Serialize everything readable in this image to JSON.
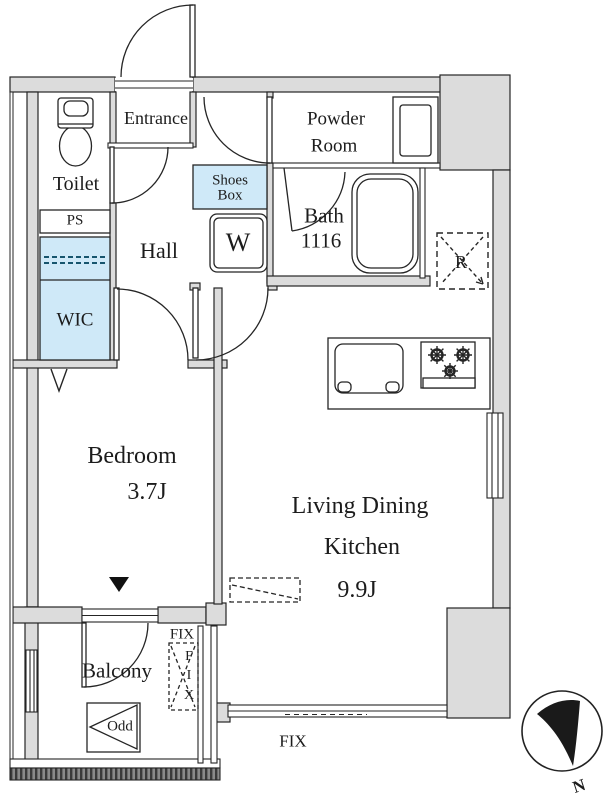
{
  "plan": {
    "labels": {
      "entrance": "Entrance",
      "toilet": "Toilet",
      "ps": "PS",
      "wic": "WIC",
      "hall": "Hall",
      "shoes_box_line1": "Shoes",
      "shoes_box_line2": "Box",
      "washer": "W",
      "powder_room_line1": "Powder",
      "powder_room_line2": "Room",
      "bath_line1": "Bath",
      "bath_line2": "1116",
      "refrigerator": "R",
      "bedroom": "Bedroom",
      "bedroom_size": "3.7J",
      "ldk_line1": "Living Dining",
      "ldk_line2": "Kitchen",
      "ldk_size": "9.9J",
      "balcony": "Balcony",
      "outdoor_unit": "Odd",
      "fix_balcony": "FIX",
      "fix_vertical": [
        "F",
        "I",
        "X"
      ],
      "fix_bottom": "FIX",
      "north": "N"
    },
    "colors": {
      "wall_fill": "#dcdcdc",
      "closet_fill": "#cfe9f8",
      "line": "#252525",
      "hatch_dark": "#3a3a3a",
      "hatch_mid": "#8a8a8a"
    }
  }
}
